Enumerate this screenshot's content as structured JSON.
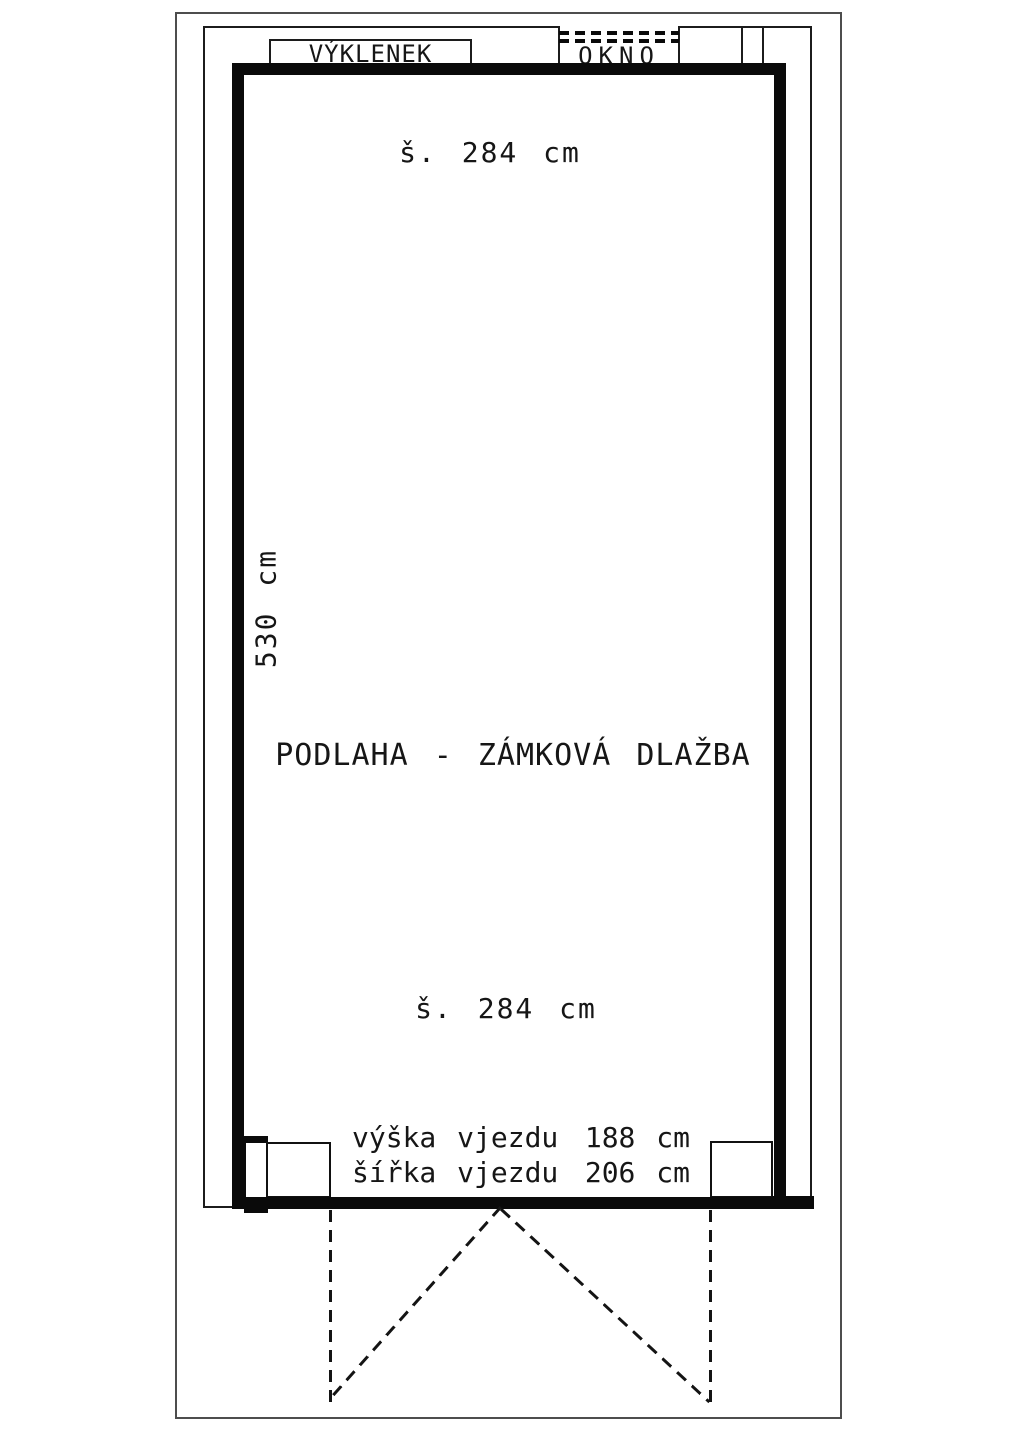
{
  "labels": {
    "niche": "VÝKLENEK",
    "window": "OKNO",
    "width_top": "š. 284 cm",
    "height_left": "530 cm",
    "floor": "PODLAHA - ZÁMKOVÁ DLAŽBA",
    "width_bottom": "š. 284 cm"
  },
  "entrance": {
    "height_label": "výška vjezdu",
    "height_value": "188 cm",
    "width_label": "šířka vjezdu",
    "width_value": "206 cm"
  },
  "measurements": {
    "room_width_cm": 284,
    "room_length_cm": 530,
    "entrance_height_cm": 188,
    "entrance_width_cm": 206
  },
  "colors": {
    "ink": "#0a0a0a",
    "paper": "#ffffff"
  }
}
